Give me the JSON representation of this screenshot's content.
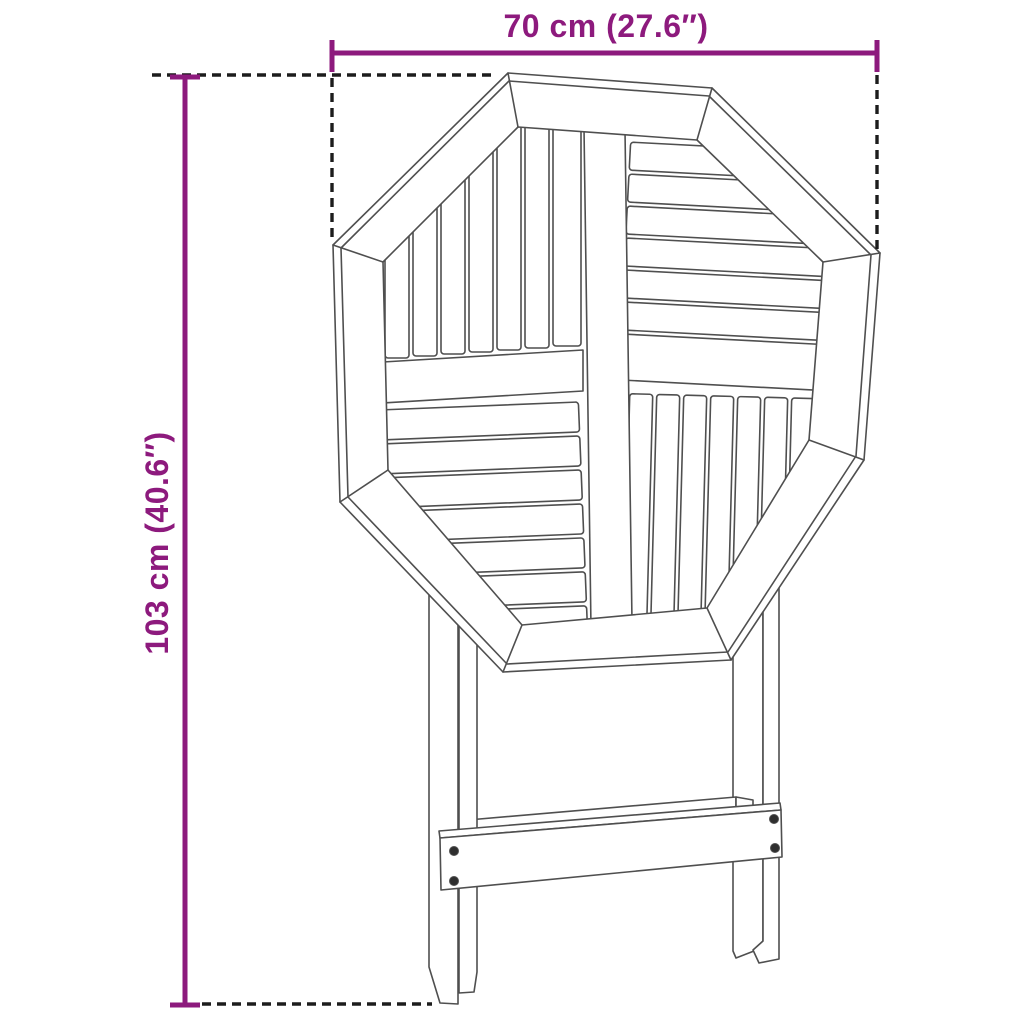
{
  "page": {
    "background_color": "#ffffff"
  },
  "annotations": {
    "width_dimension": {
      "label": "70 cm (27.6″)"
    },
    "height_dimension": {
      "label": "103 cm (40.6″)"
    }
  },
  "style": {
    "dimension_color": "#8d1a7d",
    "extension_line_color": "#1c1c1c",
    "drawing_line_color": "#4f4f4f",
    "screw_color": "#2f2f2f"
  }
}
